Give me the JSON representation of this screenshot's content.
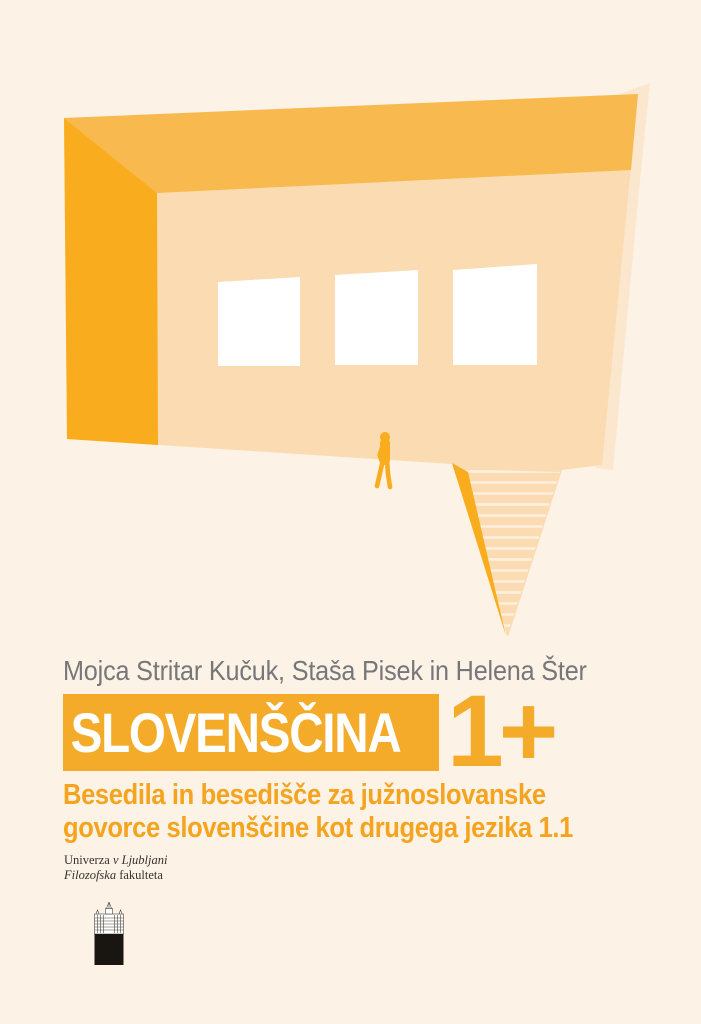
{
  "cover": {
    "author_line": "Mojca Stritar Kučuk, Staša Pisek in Helena Šter",
    "title": "SLOVENŠČINA",
    "title_suffix": "1+",
    "subtitle_line1": "Besedila in besedišče za južnoslovanske",
    "subtitle_line2": "govorce slovenščine kot drugega jezika 1.1"
  },
  "publisher": {
    "line1_regular": "Univerza ",
    "line1_italic": "v Ljubljani",
    "line2_italic": "Filozofska",
    "line2_regular": " fakulteta"
  },
  "icons": {
    "illustration": "speech-bubble-building-illustration",
    "person": "walking-person-silhouette",
    "logo": "university-of-ljubljana-building-logo"
  },
  "colors": {
    "background": "#FCF2E5",
    "facade": "#FBDBB1",
    "facade_back": "#FBE7CE",
    "roof": "#F8B94E",
    "side_wall": "#F9AD1E",
    "accent_orange": "#F4AB29",
    "subtitle_orange": "#F4A41F",
    "stair_stripe": "#FCEFDC",
    "window_white": "#FFFFFF",
    "author_gray": "#76777A",
    "publisher_text": "#36312C",
    "logo_black": "#191611"
  }
}
